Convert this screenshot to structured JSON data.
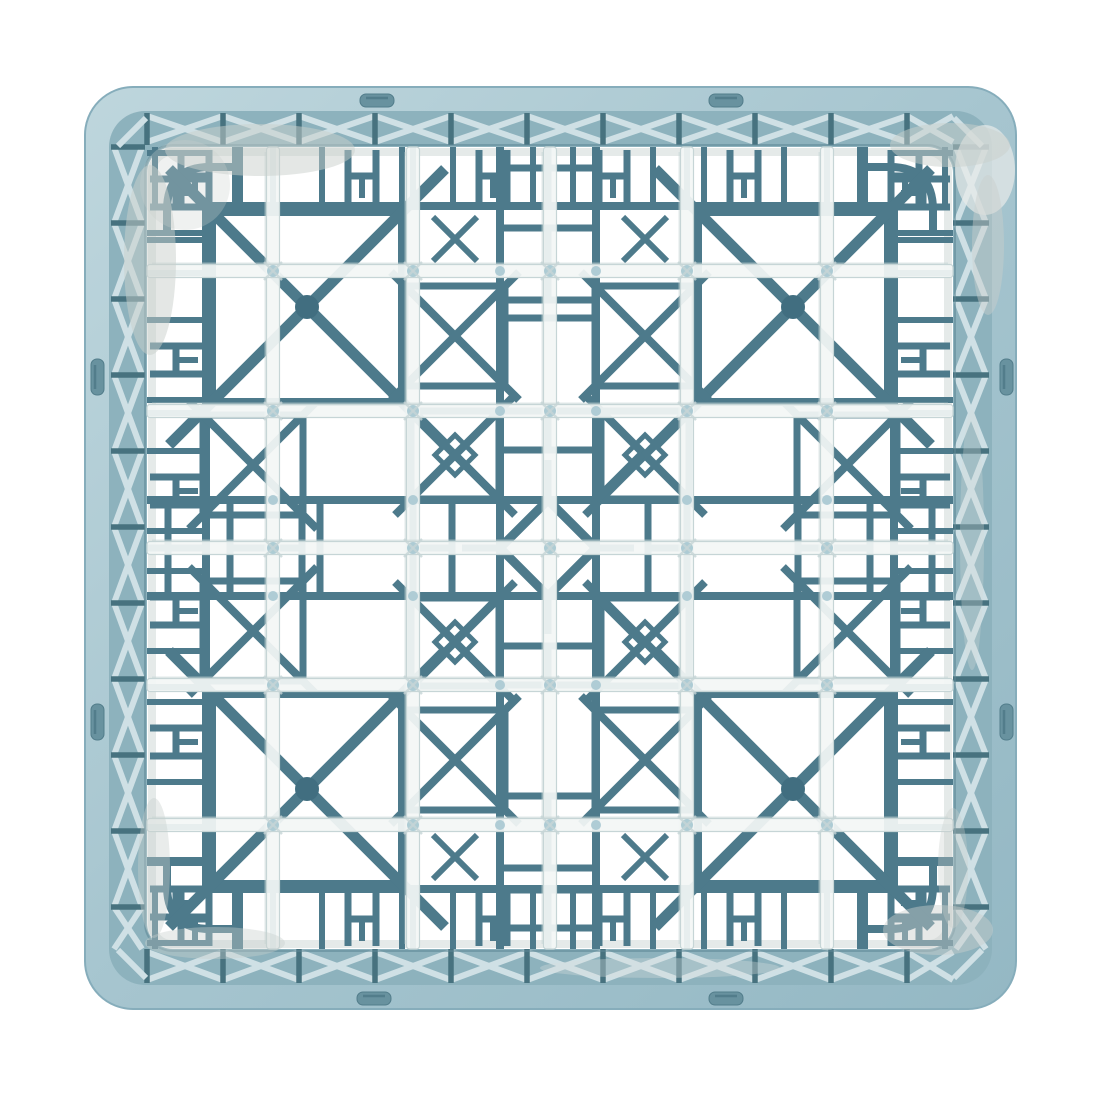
{
  "meta": {
    "domain": "Natural-Image",
    "subject": "Light blue plastic commercial dishwasher glass rack, photographed top-down on a plain white background",
    "background": "#ffffff"
  },
  "colors": {
    "background": "#ffffff",
    "rim_base": "#a6c5cf",
    "rim_light": "#bed6dd",
    "rim_dark": "#94b8c4",
    "rim_outline": "#86adbb",
    "wall_band_base": "#8db2bd",
    "wall_band_brace": "#cfe0e5",
    "wall_band_post": "#47727f",
    "wall_band_shadow": "#5d8795",
    "floor_lattice": "#4d7a8b",
    "floor_lattice_dark": "#416e80",
    "divider_wall": "#f3f6f5",
    "divider_edge": "#c6d5d6",
    "divider_bump": "#a5c6d0",
    "floor_lip": "#dce3e1",
    "sheen": "#c9cfcc",
    "slot_fill": "#68929f",
    "slot_shadow": "#527d8b"
  },
  "geometry": {
    "canvas": [
      1100,
      1100
    ],
    "rim_outer": [
      85,
      87,
      931,
      922,
      48
    ],
    "rim_inner": [
      109,
      111,
      883,
      874,
      36
    ],
    "floor": [
      147,
      147,
      806,
      802,
      26
    ],
    "floor_lip": [
      152,
      152,
      796,
      792,
      20
    ],
    "band_cell": 76,
    "slots": {
      "h_size": [
        34,
        13
      ],
      "v_size": [
        13,
        36
      ],
      "top": [
        [
          360,
          94
        ],
        [
          709,
          94
        ]
      ],
      "bottom": [
        [
          357,
          992
        ],
        [
          709,
          992
        ]
      ],
      "left": [
        [
          91,
          359
        ],
        [
          91,
          704
        ]
      ],
      "right": [
        [
          1000,
          359
        ],
        [
          1000,
          704
        ]
      ]
    },
    "center": [
      548,
      548
    ],
    "walls_x": [
      273,
      413,
      550,
      687,
      827
    ],
    "walls_y": [
      271,
      411,
      548,
      685,
      825
    ],
    "wall_width": 13,
    "edge_ring": [
      206,
      206,
      688,
      683
    ],
    "edge_h_top_x": [
      195,
      362,
      493,
      613,
      744,
      905
    ],
    "edge_h_left_y": [
      193,
      360,
      491,
      611,
      742,
      903
    ],
    "edge_rungs": [
      240,
      273,
      413,
      687,
      827,
      860
    ],
    "corner_inset": 20,
    "corner_radius": 43,
    "big_x": {
      "half": 95,
      "overshoot": 43,
      "dot_r": 12,
      "centers": [
        [
          307,
          307
        ],
        [
          793,
          307
        ],
        [
          307,
          789
        ],
        [
          793,
          789
        ]
      ]
    },
    "medium_x": {
      "half": 44,
      "overshoot": 16,
      "inner_diamond": 20,
      "centers": [
        [
          455,
          455
        ],
        [
          645,
          455
        ],
        [
          455,
          642
        ],
        [
          645,
          642
        ]
      ]
    },
    "flank_x": {
      "half": 50,
      "overshoot": 14,
      "centers": [
        [
          253,
          465
        ],
        [
          253,
          631
        ],
        [
          847,
          465
        ],
        [
          847,
          631
        ],
        [
          455,
          336
        ],
        [
          645,
          336
        ],
        [
          455,
          760
        ],
        [
          645,
          760
        ]
      ]
    },
    "small_x": {
      "half": 22,
      "centers": [
        [
          455,
          239
        ],
        [
          645,
          239
        ],
        [
          455,
          857
        ],
        [
          645,
          857
        ]
      ]
    },
    "center_ring": [
      500,
      500,
      96,
      96
    ],
    "diamond": [
      [
        548,
        500
      ],
      [
        596,
        548
      ],
      [
        548,
        596
      ],
      [
        500,
        548
      ]
    ],
    "ring_arm": 46,
    "hband": {
      "rails_y": [
        500,
        596
      ],
      "spans": [
        [
          147,
          500
        ],
        [
          596,
          953
        ]
      ],
      "rungs_x": [
        168,
        206,
        230,
        302,
        320,
        413,
        452,
        648,
        687,
        798,
        870,
        894,
        932
      ],
      "mid_y": 548,
      "mid_segs": [
        [
          147,
          206
        ],
        [
          230,
          302
        ],
        [
          413,
          452
        ],
        [
          462,
          500
        ],
        [
          596,
          634
        ],
        [
          648,
          687
        ],
        [
          798,
          870
        ],
        [
          894,
          953
        ]
      ]
    },
    "vband": {
      "rails_x": [
        500,
        596
      ],
      "spans": [
        [
          147,
          500
        ],
        [
          596,
          949
        ]
      ],
      "rungs_y": [
        168,
        206,
        228,
        300,
        318,
        411,
        450,
        646,
        685,
        796,
        868,
        890,
        928
      ],
      "mid_x": 548,
      "mid_segs": [
        [
          147,
          206
        ],
        [
          228,
          300
        ],
        [
          411,
          450
        ],
        [
          460,
          500
        ],
        [
          596,
          634
        ],
        [
          646,
          685
        ],
        [
          796,
          868
        ],
        [
          890,
          949
        ]
      ]
    }
  }
}
